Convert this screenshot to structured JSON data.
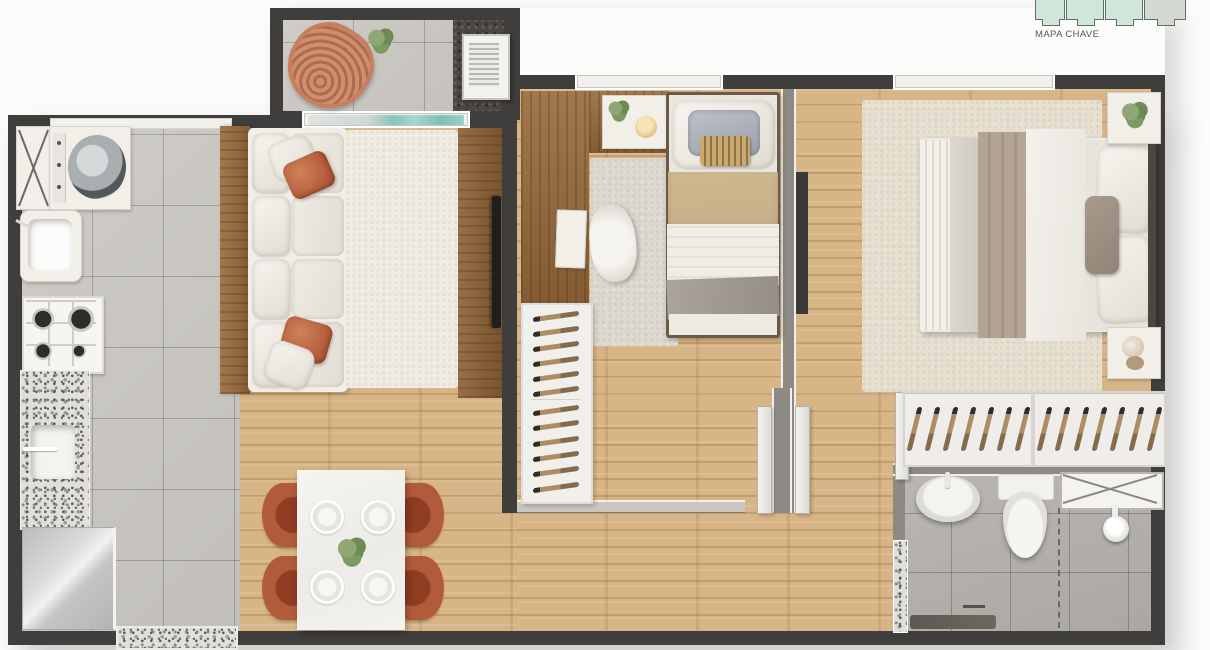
{
  "keymap": {
    "label": "MAPA CHAVE",
    "units": [
      {
        "fill": "mint"
      },
      {
        "fill": "mint"
      },
      {
        "fill": "mint"
      },
      {
        "fill": "gray"
      }
    ]
  },
  "colors": {
    "wall": "#3f3e3c",
    "wood": "#d8b586",
    "tile": "#cac7c2",
    "bath-tile": "#b5b2ae",
    "granite-base": "#e0dfdc",
    "dark-floor": "#4b463f",
    "furniture-wood": "#96683a",
    "rug": "#e6dfd0",
    "terracotta": "#b35c3c",
    "terracotta-dark": "#8e3d22",
    "linen": "#f1eee8",
    "beige": "#c6b089",
    "taupe": "#b3a496",
    "glass-teal": "#86c5ba",
    "mint": "#cfe7da",
    "mint-outline": "#5f6e66"
  }
}
